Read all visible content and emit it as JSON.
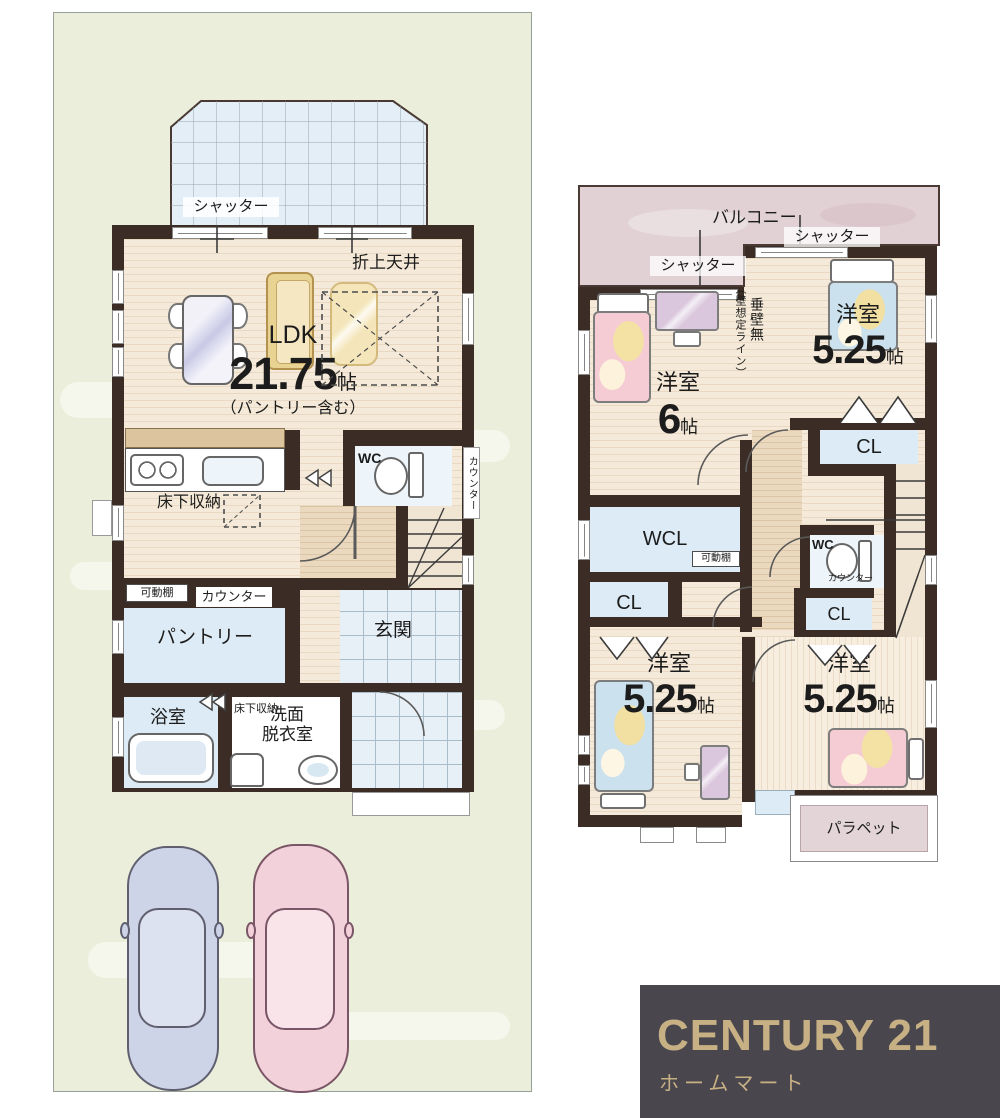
{
  "floor1": {
    "shutter": "シャッター",
    "coffered_ceiling": "折上天井",
    "ldk_name": "LDK",
    "ldk_size": "21.75",
    "ldk_unit": "帖",
    "ldk_note": "（パントリー含む）",
    "wc": "WC",
    "side_counter": "カウンター",
    "underfloor_storage": "床下収納",
    "movable_shelf": "可動棚",
    "counter": "カウンター",
    "pantry": "パントリー",
    "entrance": "玄関",
    "bath": "浴室",
    "underfloor_storage_small": "床下収納",
    "washroom_l1": "洗面",
    "washroom_l2": "脱衣室"
  },
  "floor2": {
    "balcony": "バルコニー",
    "shutter_left": "シャッター",
    "shutter_right": "シャッター",
    "room6_name": "洋室",
    "room6_size": "6",
    "unit": "帖",
    "wall_note_paren": "（壁想定ライン）",
    "wall_note": "垂壁無",
    "room525_name": "洋室",
    "room525_size": "5.25",
    "wcl": "WCL",
    "cl": "CL",
    "wc": "WC",
    "counter_small": "カウンター",
    "movable_shelf": "可動棚",
    "parapet": "パラペット"
  },
  "logo": {
    "brand": "CENTURY 21",
    "sub": "ホームマート"
  },
  "colors": {
    "wall": "#3b2c25",
    "logo_bg": "#49474d",
    "logo_gold": "#c8b085"
  }
}
